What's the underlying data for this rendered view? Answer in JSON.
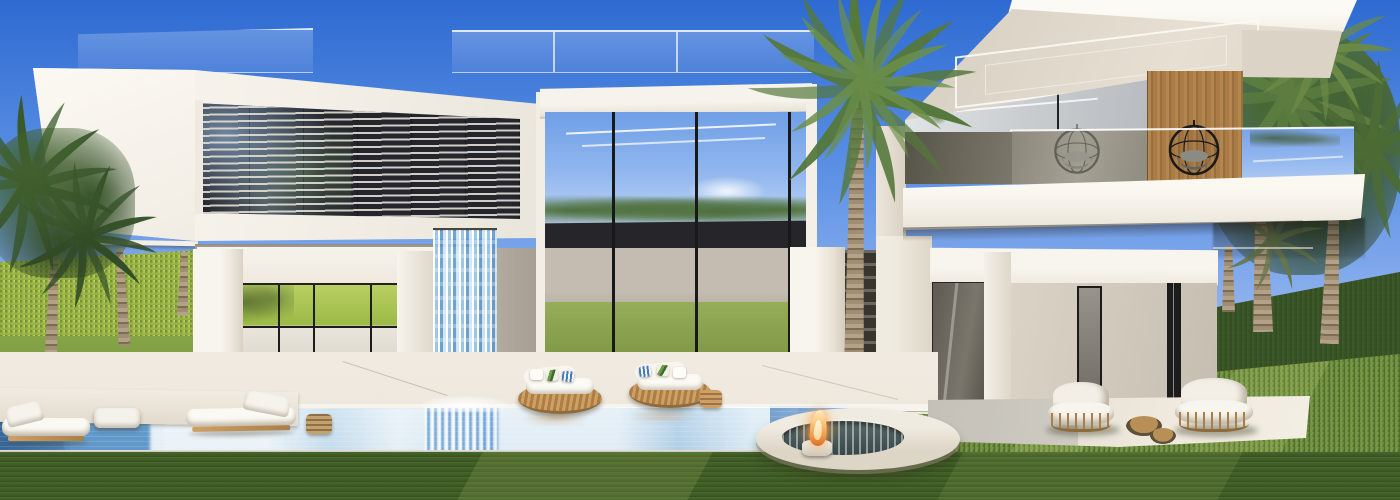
{
  "scene": {
    "description": "Photorealistic architectural rendering of a modern white luxury villa: a cantilevered louvered upper volume, a double-height glass atrium with an indoor waterfall spilling into an infinity pool, a second timber-accented volume with balcony and hanging egg chair, round rattan daybeds, chaise lounges, a sunken circular fire-pit spa, stone patio with armchairs, manicured lawns, clipped hedges and tall palm trees under a clear blue midday sky.",
    "setting": "luxury villa exterior, midday sun",
    "style": "contemporary minimalist 3D render",
    "elements": [
      "blue gradient sky",
      "rooftop glass balustrades",
      "white cantilevered upper volume with aluminum louver screen",
      "double-height glazed atrium with dark mullions reflecting sky and trees",
      "cascading waterfall feature falling into the pool",
      "ground-floor glass pavilion reflecting the bright garden hedge",
      "second villa volume with cantilevered roof and LED-lit soffit",
      "timber-clad balcony wall with black hanging egg chair",
      "mirror glass balcony balustrade reflecting palms and sky",
      "infinity-edge swimming pool with white building reflections",
      "two round rattan daybeds with white cushions and botanical pillows",
      "pair of white chaise lounges at the pool corner",
      "sunken circular spa lounge ring with fire feature",
      "stone patio with two rattan-frame armchairs and round coffee tables",
      "manicured lawns and clipped hedge walls",
      "tall palm trees and dense tropical foliage"
    ]
  },
  "palette": {
    "sky_top": "#2e6ad1",
    "sky_mid": "#5b90e4",
    "sky_low": "#8fb2ee",
    "sky_haze": "#c6d9f6",
    "white_sun": "#faf7f1",
    "white_lit": "#eae5da",
    "white_shade": "#ded8cc",
    "soffit": "#d5cec0",
    "led_strip": "#fbf9f3",
    "louver_dark": "#24262b",
    "louver_slat": "#dedbd3",
    "glass_sky": "#6f9fe6",
    "glass_dark": "#26262a",
    "interior_gray": "#aaa296",
    "wood": "#b5854f",
    "wood_dark": "#98703c",
    "green_bright": "#b5cc55",
    "hedge_left": "#a9c44d",
    "hedge_dark": "#3a5629",
    "lawn_mid": "#7a9a42",
    "lawn_right": "#67883a",
    "lawn_fore": "#425d28",
    "palm_green": "#55783c",
    "palm_light": "#86a355",
    "palm_shadow": "#2f4523",
    "trunk": "#b3a289",
    "trunk_dark": "#7d6c52",
    "pool_light": "#a9cce4",
    "pool_mid": "#77a9cf",
    "pool_deep": "#2e5f93",
    "pool_white": "#f5f9fc",
    "deck": "#eee8dd",
    "rattan": "#cf9f63",
    "rattan_dark": "#aa7f47",
    "flame": "#f49b4a",
    "flame_core": "#ffe9c4",
    "frame_black": "#1c1c1c"
  }
}
